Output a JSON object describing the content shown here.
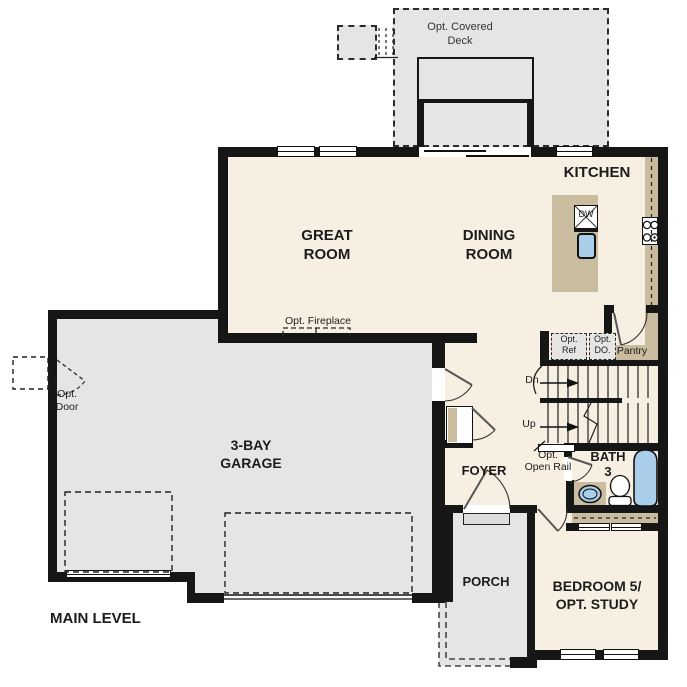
{
  "title": "MAIN LEVEL",
  "labels": {
    "deck": "Opt. Covered\nDeck",
    "kitchen": "KITCHEN",
    "great_room": "GREAT\nROOM",
    "dining_room": "DINING\nROOM",
    "dishwasher": "DW",
    "opt_fireplace": "Opt. Fireplace",
    "opt_ref": "Opt.\nRef",
    "opt_do": "Opt.\nDO.",
    "pantry": "Pantry",
    "stairs_down": "Dn",
    "stairs_up": "Up",
    "opt_open_rail": "Opt.\nOpen Rail",
    "bath": "BATH\n3",
    "opt_door": "Opt.\nDoor",
    "garage": "3-BAY\nGARAGE",
    "foyer": "FOYER",
    "porch": "PORCH",
    "bedroom": "BEDROOM 5/\nOPT. STUDY",
    "main_level": "MAIN LEVEL"
  },
  "colors": {
    "floor": "#f7efe2",
    "outdoor": "#e5e5e3",
    "counter": "#c9bc9f",
    "fixture": "#aacdea",
    "wall": "#161616"
  }
}
